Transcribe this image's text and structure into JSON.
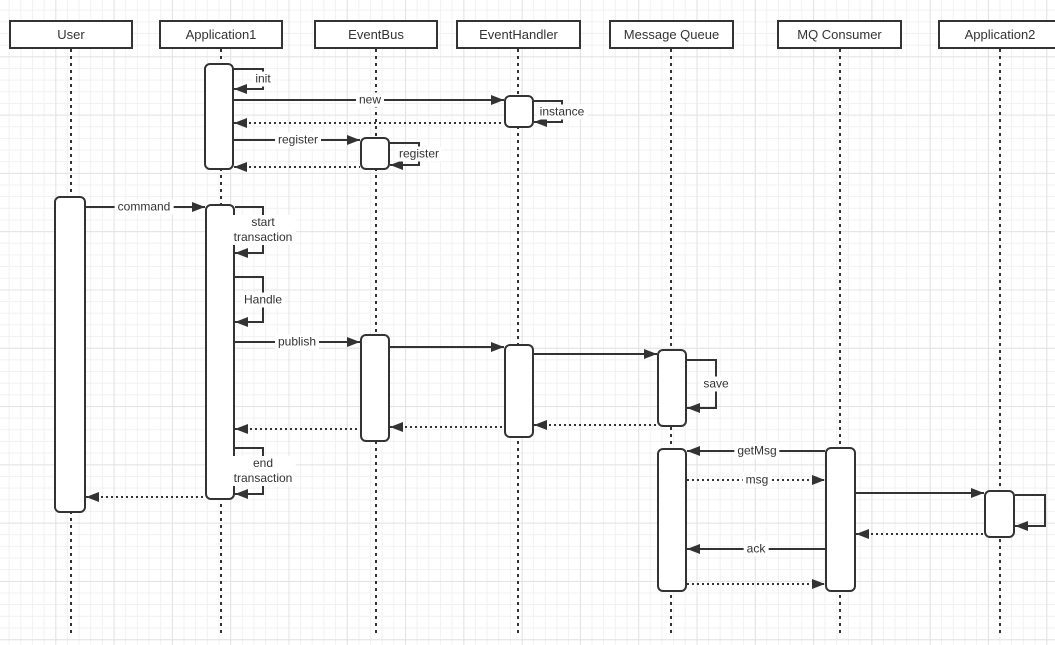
{
  "diagram": {
    "type": "uml-sequence-diagram",
    "colors": {
      "stroke": "#333333",
      "fill": "#ffffff",
      "text": "#333333",
      "grid_minor": "#f1f1f1",
      "grid_major": "#e3e3e3",
      "background": "#ffffff"
    },
    "header": {
      "y": 20,
      "h": 29
    },
    "lifelines": {
      "top": 49,
      "bottom": 633
    },
    "participants": [
      {
        "label": "User",
        "x": 9,
        "w": 124,
        "cx": 71
      },
      {
        "label": "Application1",
        "x": 159,
        "w": 124,
        "cx": 221
      },
      {
        "label": "EventBus",
        "x": 314,
        "w": 124,
        "cx": 376
      },
      {
        "label": "EventHandler",
        "x": 456,
        "w": 125,
        "cx": 518
      },
      {
        "label": "Message Queue",
        "x": 609,
        "w": 125,
        "cx": 671
      },
      {
        "label": "MQ Consumer",
        "x": 777,
        "w": 125,
        "cx": 840
      },
      {
        "label": "Application2",
        "x": 938,
        "w": 124,
        "cx": 1000
      }
    ],
    "activations": [
      {
        "owner": "Application1",
        "x": 204,
        "y": 63,
        "w": 30,
        "h": 107
      },
      {
        "owner": "EventHandler",
        "x": 504,
        "y": 95,
        "w": 30,
        "h": 33
      },
      {
        "owner": "EventBus",
        "x": 360,
        "y": 137,
        "w": 30,
        "h": 33
      },
      {
        "owner": "User",
        "x": 54,
        "y": 196,
        "w": 32,
        "h": 317
      },
      {
        "owner": "Application1",
        "x": 205,
        "y": 204,
        "w": 30,
        "h": 296
      },
      {
        "owner": "EventBus",
        "x": 360,
        "y": 334,
        "w": 30,
        "h": 108
      },
      {
        "owner": "EventHandler",
        "x": 504,
        "y": 344,
        "w": 30,
        "h": 94
      },
      {
        "owner": "Message Queue",
        "x": 657,
        "y": 349,
        "w": 30,
        "h": 78
      },
      {
        "owner": "Message Queue",
        "x": 657,
        "y": 448,
        "w": 30,
        "h": 144
      },
      {
        "owner": "MQ Consumer",
        "x": 825,
        "y": 447,
        "w": 31,
        "h": 145
      },
      {
        "owner": "Application2",
        "x": 984,
        "y": 490,
        "w": 31,
        "h": 48
      }
    ],
    "messages": [
      {
        "id": "init",
        "kind": "self",
        "label": "init",
        "x": 234,
        "top": 69,
        "bottom": 89,
        "w": 30
      },
      {
        "id": "new",
        "kind": "solid",
        "label": "new",
        "x1": 234,
        "x2": 504,
        "y": 100,
        "dir": "right",
        "lx": 370
      },
      {
        "id": "instance",
        "kind": "self",
        "label": "instance",
        "x": 534,
        "top": 101,
        "bottom": 122,
        "w": 29
      },
      {
        "id": "return-instance",
        "kind": "dotted",
        "label": "",
        "x1": 234,
        "x2": 504,
        "y": 123,
        "dir": "left"
      },
      {
        "id": "register",
        "kind": "solid",
        "label": "register",
        "x1": 234,
        "x2": 360,
        "y": 140,
        "dir": "right",
        "lx": 298
      },
      {
        "id": "register-self",
        "kind": "self",
        "label": "register",
        "x": 390,
        "top": 143,
        "bottom": 165,
        "w": 30
      },
      {
        "id": "return-register",
        "kind": "dotted",
        "label": "",
        "x1": 234,
        "x2": 360,
        "y": 167,
        "dir": "left"
      },
      {
        "id": "command",
        "kind": "solid",
        "label": "command",
        "x1": 86,
        "x2": 205,
        "y": 207,
        "dir": "right",
        "lx": 144
      },
      {
        "id": "start-transaction",
        "kind": "self",
        "label": "start\ntransaction",
        "x": 235,
        "top": 207,
        "bottom": 253,
        "w": 29
      },
      {
        "id": "handle",
        "kind": "self",
        "label": "Handle",
        "x": 235,
        "top": 277,
        "bottom": 322,
        "w": 29
      },
      {
        "id": "publish",
        "kind": "solid",
        "label": "publish",
        "x1": 235,
        "x2": 360,
        "y": 342,
        "dir": "right",
        "lx": 297
      },
      {
        "id": "bus-to-handler",
        "kind": "solid",
        "label": "",
        "x1": 390,
        "x2": 504,
        "y": 347,
        "dir": "right"
      },
      {
        "id": "handler-to-queue",
        "kind": "solid",
        "label": "",
        "x1": 534,
        "x2": 657,
        "y": 354,
        "dir": "right"
      },
      {
        "id": "save",
        "kind": "self",
        "label": "save",
        "x": 687,
        "top": 360,
        "bottom": 408,
        "w": 30
      },
      {
        "id": "return-queue-handler",
        "kind": "dotted",
        "label": "",
        "x1": 534,
        "x2": 657,
        "y": 425,
        "dir": "left"
      },
      {
        "id": "return-handler-bus",
        "kind": "dotted",
        "label": "",
        "x1": 390,
        "x2": 504,
        "y": 427,
        "dir": "left"
      },
      {
        "id": "return-bus-app1",
        "kind": "dotted",
        "label": "",
        "x1": 235,
        "x2": 360,
        "y": 429,
        "dir": "left"
      },
      {
        "id": "end-transaction",
        "kind": "self",
        "label": "end\ntransaction",
        "x": 235,
        "top": 448,
        "bottom": 494,
        "w": 29
      },
      {
        "id": "return-app1-user",
        "kind": "dotted",
        "label": "",
        "x1": 86,
        "x2": 205,
        "y": 497,
        "dir": "left"
      },
      {
        "id": "getmsg",
        "kind": "solid",
        "label": "getMsg",
        "x1": 687,
        "x2": 825,
        "y": 451,
        "dir": "left",
        "lx": 757
      },
      {
        "id": "msg",
        "kind": "dotted",
        "label": "msg",
        "x1": 687,
        "x2": 825,
        "y": 480,
        "dir": "right",
        "lx": 757
      },
      {
        "id": "consumer-to-app2",
        "kind": "solid",
        "label": "",
        "x1": 856,
        "x2": 984,
        "y": 493,
        "dir": "right"
      },
      {
        "id": "app2-self",
        "kind": "self",
        "label": "",
        "x": 1015,
        "top": 495,
        "bottom": 526,
        "w": 31
      },
      {
        "id": "return-app2-consumer",
        "kind": "dotted",
        "label": "",
        "x1": 856,
        "x2": 984,
        "y": 534,
        "dir": "left"
      },
      {
        "id": "ack",
        "kind": "solid",
        "label": "ack",
        "x1": 687,
        "x2": 825,
        "y": 549,
        "dir": "left",
        "lx": 756
      },
      {
        "id": "return-queue-consumer",
        "kind": "dotted",
        "label": "",
        "x1": 687,
        "x2": 825,
        "y": 584,
        "dir": "right"
      }
    ]
  }
}
